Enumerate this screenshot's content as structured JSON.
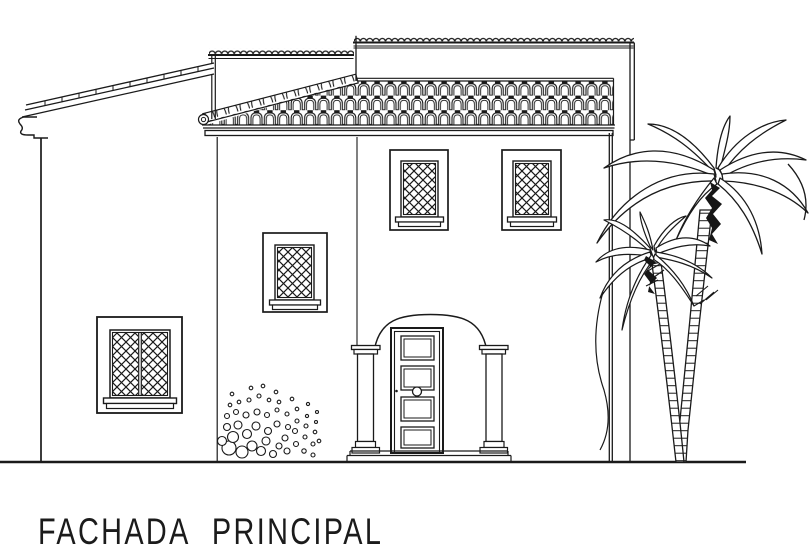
{
  "title": {
    "label": "FACHADA PRINCIPAL"
  },
  "palette": {
    "background": "#ffffff",
    "line": "#1a1a1a"
  },
  "scene": {
    "type": "architectural-elevation-drawing",
    "building": {
      "left_wing": {
        "roof": "sloped-shed-roof",
        "window": "double-casement-lattice-window"
      },
      "middle_tower": {
        "parapet": "scalloped-tile-parapet",
        "window": "lattice-window"
      },
      "main_block": {
        "parapet": "scalloped-tile-parapet",
        "roof": "spanish-barrel-tile-roof",
        "upper_windows": 2,
        "entrance": {
          "style": "arched-portal-with-columns",
          "door_panels": 4,
          "knob": true
        }
      }
    },
    "landscape": {
      "palm_trees": 2,
      "shrub": "scattered-circle-bush",
      "ground_line": true
    }
  }
}
